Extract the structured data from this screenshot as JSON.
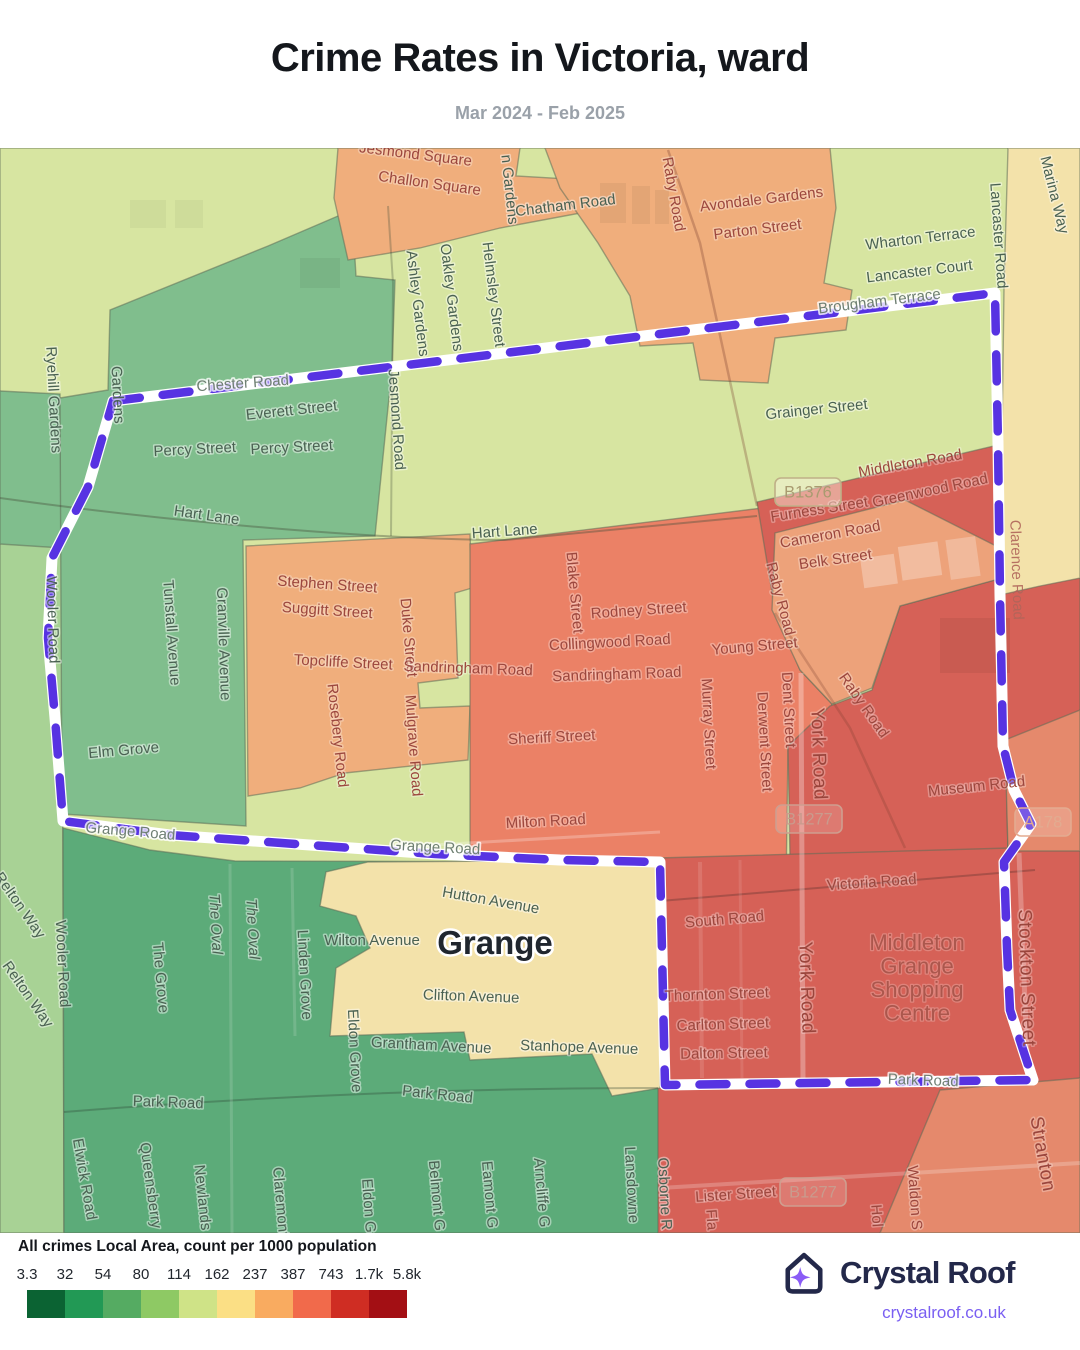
{
  "header": {
    "title": "Crime Rates in Victoria, ward",
    "subtitle": "Mar 2024 - Feb 2025"
  },
  "legend": {
    "title": "All crimes Local Area, count per 1000 population",
    "ticks": [
      "3.3",
      "32",
      "54",
      "80",
      "114",
      "162",
      "237",
      "387",
      "743",
      "1.7k",
      "5.8k"
    ],
    "colors": [
      "#0b6333",
      "#229955",
      "#55ab62",
      "#8ec964",
      "#cfe387",
      "#fbdf85",
      "#f9ab60",
      "#f16a4b",
      "#cf2d23",
      "#a30f14"
    ]
  },
  "footer": {
    "brand": "Crystal Roof",
    "url": "crystalroof.co.uk",
    "brand_color": "#23284a",
    "accent_color": "#8a5cf6",
    "link_color": "#7a5ff2"
  },
  "map": {
    "boundary_color": "#5733e2",
    "colors": {
      "pale_green": "#d7e5a1",
      "green": "#80be8d",
      "dark_green": "#5cab79",
      "light_green": "#a8d295",
      "orange": "#f0ae7c",
      "light_orange": "#eda27a",
      "salmon": "#eb8166",
      "red": "#d66157",
      "red_light": "#e5896c",
      "pale_yellow": "#f3e2aa"
    },
    "place": {
      "t": "Grange",
      "x": 495,
      "y": 806
    },
    "shopping_centre": {
      "lines": [
        "Middleton",
        "Grange",
        "Shopping",
        "Centre"
      ],
      "x": 917,
      "y": 802,
      "lh": 23.5
    },
    "badges": [
      {
        "t": "B1376",
        "x": 808,
        "y": 344,
        "theme": "tan"
      },
      {
        "t": "B1277",
        "x": 809,
        "y": 671,
        "theme": "red"
      },
      {
        "t": "B1277",
        "x": 813,
        "y": 1044,
        "theme": "red"
      },
      {
        "t": "A178",
        "x": 1043,
        "y": 674,
        "theme": "lightred"
      }
    ],
    "labels": [
      {
        "t": "Jesmond Square",
        "x": 415,
        "y": 11,
        "r": 7,
        "c": "rd"
      },
      {
        "t": "Challon Square",
        "x": 429,
        "y": 40,
        "r": 8,
        "c": "rd"
      },
      {
        "t": "n Gardens",
        "x": 505,
        "y": 42,
        "r": 84,
        "c": "g"
      },
      {
        "t": "Chatham Road",
        "x": 566,
        "y": 62,
        "r": -7,
        "c": "g"
      },
      {
        "t": "Raby Road",
        "x": 669,
        "y": 47,
        "r": 80,
        "c": "rd"
      },
      {
        "t": "Avondale Gardens",
        "x": 762,
        "y": 56,
        "r": -7,
        "c": "rd"
      },
      {
        "t": "Parton Street",
        "x": 758,
        "y": 86,
        "r": -7,
        "c": "rd"
      },
      {
        "t": "Wharton Terrace",
        "x": 921,
        "y": 95,
        "r": -7,
        "c": "g"
      },
      {
        "t": "Lancaster Court",
        "x": 920,
        "y": 128,
        "r": -7,
        "c": "g"
      },
      {
        "t": "Lancaster Road",
        "x": 994,
        "y": 88,
        "r": 86,
        "c": "g"
      },
      {
        "t": "Marina Way",
        "x": 1050,
        "y": 48,
        "r": 76,
        "c": "g"
      },
      {
        "t": "Ashley Gardens",
        "x": 413,
        "y": 156,
        "r": 83,
        "c": "g"
      },
      {
        "t": "Oakley Gardens",
        "x": 447,
        "y": 150,
        "r": 83,
        "c": "g"
      },
      {
        "t": "Helmsley Street",
        "x": 489,
        "y": 147,
        "r": 83,
        "c": "g"
      },
      {
        "t": "Ryehill Gardens",
        "x": 49,
        "y": 252,
        "r": 87,
        "c": "g"
      },
      {
        "t": "Gardens",
        "x": 113,
        "y": 247,
        "r": 87,
        "c": "g"
      },
      {
        "t": "Chester Road",
        "x": 243,
        "y": 240,
        "r": -4,
        "c": "ft"
      },
      {
        "t": "Everett Street",
        "x": 292,
        "y": 267,
        "r": -6,
        "c": "g"
      },
      {
        "t": "Percy Street",
        "x": 195,
        "y": 306,
        "r": -3,
        "c": "g"
      },
      {
        "t": "Percy Street",
        "x": 292,
        "y": 304,
        "r": -3,
        "c": "g"
      },
      {
        "t": "Jesmond Road",
        "x": 392,
        "y": 272,
        "r": 86,
        "c": "g"
      },
      {
        "t": "Brougham Terrace",
        "x": 880,
        "y": 158,
        "r": -7,
        "c": "ft"
      },
      {
        "t": "Grainger Street",
        "x": 817,
        "y": 266,
        "r": -6,
        "c": "g"
      },
      {
        "t": "Middleton Road",
        "x": 911,
        "y": 320,
        "r": -10,
        "c": "rd"
      },
      {
        "t": "Furness Street",
        "x": 820,
        "y": 366,
        "r": -9,
        "c": "rd"
      },
      {
        "t": "Greenwood Road",
        "x": 931,
        "y": 347,
        "r": -12,
        "c": "rd"
      },
      {
        "t": "Cameron Road",
        "x": 831,
        "y": 391,
        "r": -10,
        "c": "rd"
      },
      {
        "t": "Belk Street",
        "x": 836,
        "y": 416,
        "r": -8,
        "c": "rd"
      },
      {
        "t": "Hart Lane",
        "x": 206,
        "y": 372,
        "r": 8,
        "c": "g"
      },
      {
        "t": "Hart Lane",
        "x": 505,
        "y": 388,
        "r": -4,
        "c": "g"
      },
      {
        "t": "Raby Road",
        "x": 776,
        "y": 452,
        "r": 75,
        "c": "rd"
      },
      {
        "t": "Stephen Street",
        "x": 327,
        "y": 441,
        "r": 4,
        "c": "rd"
      },
      {
        "t": "Suggitt Street",
        "x": 327,
        "y": 467,
        "r": 4,
        "c": "rd"
      },
      {
        "t": "Topcliffe Street",
        "x": 343,
        "y": 519,
        "r": 3,
        "c": "rd"
      },
      {
        "t": "Duke Street",
        "x": 404,
        "y": 490,
        "r": 85,
        "c": "rd"
      },
      {
        "t": "Sandringham Road",
        "x": 468,
        "y": 525,
        "r": 2,
        "c": "rd"
      },
      {
        "t": "Blake Street",
        "x": 570,
        "y": 445,
        "r": 85,
        "c": "rd"
      },
      {
        "t": "Rodney Street",
        "x": 639,
        "y": 467,
        "r": -4,
        "c": "rd"
      },
      {
        "t": "Collingwood Road",
        "x": 610,
        "y": 499,
        "r": -3,
        "c": "rd"
      },
      {
        "t": "Sandringham Road",
        "x": 617,
        "y": 531,
        "r": -2,
        "c": "rd"
      },
      {
        "t": "Young Street",
        "x": 755,
        "y": 503,
        "r": -5,
        "c": "rd"
      },
      {
        "t": "Rosebery Road",
        "x": 333,
        "y": 588,
        "r": 84,
        "c": "rd"
      },
      {
        "t": "Mulgrave Road",
        "x": 409,
        "y": 598,
        "r": 86,
        "c": "rd"
      },
      {
        "t": "Sheriff Street",
        "x": 552,
        "y": 594,
        "r": -3,
        "c": "rd"
      },
      {
        "t": "Murray Street",
        "x": 704,
        "y": 576,
        "r": 87,
        "c": "rd"
      },
      {
        "t": "Derwent Street",
        "x": 760,
        "y": 594,
        "r": 87,
        "c": "rd"
      },
      {
        "t": "Dent Street",
        "x": 784,
        "y": 562,
        "r": 87,
        "c": "rd"
      },
      {
        "t": "York Road",
        "x": 813,
        "y": 606,
        "r": 88,
        "c": "rb"
      },
      {
        "t": "Raby Road",
        "x": 860,
        "y": 560,
        "r": 55,
        "c": "rd"
      },
      {
        "t": "Museum Road",
        "x": 977,
        "y": 643,
        "r": -6,
        "c": "rd"
      },
      {
        "t": "Clarence Road",
        "x": 1012,
        "y": 422,
        "r": 88,
        "c": "rf"
      },
      {
        "t": "Elm Grove",
        "x": 124,
        "y": 607,
        "r": -5,
        "c": "g"
      },
      {
        "t": "Tunstall Avenue",
        "x": 167,
        "y": 485,
        "r": 86,
        "c": "g"
      },
      {
        "t": "Granville Avenue",
        "x": 219,
        "y": 496,
        "r": 88,
        "c": "g"
      },
      {
        "t": "Wooler Road",
        "x": 48,
        "y": 472,
        "r": 88,
        "c": "g"
      },
      {
        "t": "Grange Road",
        "x": 130,
        "y": 688,
        "r": 5,
        "c": "ft"
      },
      {
        "t": "Grange Road",
        "x": 435,
        "y": 704,
        "r": 3,
        "c": "ft"
      },
      {
        "t": "Milton Road",
        "x": 546,
        "y": 678,
        "r": -3,
        "c": "rd"
      },
      {
        "t": "Victoria Road",
        "x": 872,
        "y": 739,
        "r": -4,
        "c": "rd"
      },
      {
        "t": "South Road",
        "x": 725,
        "y": 776,
        "r": -5,
        "c": "rd"
      },
      {
        "t": "Relton Way",
        "x": 16,
        "y": 760,
        "r": 55,
        "c": "g"
      },
      {
        "t": "Relton Way",
        "x": 24,
        "y": 849,
        "r": 55,
        "c": "g"
      },
      {
        "t": "Wooler Road",
        "x": 58,
        "y": 816,
        "r": 87,
        "c": "g"
      },
      {
        "t": "The Grove",
        "x": 156,
        "y": 830,
        "r": 85,
        "c": "g"
      },
      {
        "t": "The Oval",
        "x": 211,
        "y": 776,
        "r": 87,
        "c": "gi"
      },
      {
        "t": "The Oval",
        "x": 248,
        "y": 781,
        "r": 87,
        "c": "gi"
      },
      {
        "t": "Linden Grove",
        "x": 300,
        "y": 827,
        "r": 87,
        "c": "g"
      },
      {
        "t": "Wilton Avenue",
        "x": 372,
        "y": 797,
        "r": 0,
        "c": "g"
      },
      {
        "t": "Hutton Avenue",
        "x": 490,
        "y": 757,
        "r": 10,
        "c": "g"
      },
      {
        "t": "Clifton Avenue",
        "x": 471,
        "y": 853,
        "r": 2,
        "c": "g"
      },
      {
        "t": "Grantham Avenue",
        "x": 431,
        "y": 902,
        "r": 3,
        "c": "g"
      },
      {
        "t": "Stanhope Avenue",
        "x": 579,
        "y": 904,
        "r": 2,
        "c": "g"
      },
      {
        "t": "Eldon Grove",
        "x": 350,
        "y": 903,
        "r": 87,
        "c": "g"
      },
      {
        "t": "Thornton Street",
        "x": 717,
        "y": 851,
        "r": -2,
        "c": "rd"
      },
      {
        "t": "Carlton Street",
        "x": 723,
        "y": 881,
        "r": -2,
        "c": "rd"
      },
      {
        "t": "Dalton Street",
        "x": 724,
        "y": 910,
        "r": -1,
        "c": "rd"
      },
      {
        "t": "York Road",
        "x": 801,
        "y": 840,
        "r": 88,
        "c": "rb"
      },
      {
        "t": "Stockton Street",
        "x": 1021,
        "y": 830,
        "r": 88,
        "c": "rb"
      },
      {
        "t": "Park Road",
        "x": 168,
        "y": 959,
        "r": 2,
        "c": "g"
      },
      {
        "t": "Park Road",
        "x": 437,
        "y": 951,
        "r": 6,
        "c": "g"
      },
      {
        "t": "Park Road",
        "x": 923,
        "y": 937,
        "r": 2,
        "c": "ft"
      },
      {
        "t": "Lister Street",
        "x": 736,
        "y": 1051,
        "r": -4,
        "c": "rd"
      },
      {
        "t": "Stranton",
        "x": 1037,
        "y": 1007,
        "r": 80,
        "c": "rb"
      },
      {
        "t": "Waldon S",
        "x": 910,
        "y": 1050,
        "r": 86,
        "c": "rd"
      },
      {
        "t": "Hol",
        "x": 872,
        "y": 1068,
        "r": 86,
        "c": "rd"
      },
      {
        "t": "Fla",
        "x": 707,
        "y": 1072,
        "r": 86,
        "c": "rd"
      },
      {
        "t": "Elwick Road",
        "x": 80,
        "y": 1032,
        "r": 80,
        "c": "g"
      },
      {
        "t": "Queensberry",
        "x": 146,
        "y": 1038,
        "r": 82,
        "c": "g"
      },
      {
        "t": "Newlands",
        "x": 198,
        "y": 1050,
        "r": 84,
        "c": "g"
      },
      {
        "t": "Claremont",
        "x": 276,
        "y": 1054,
        "r": 85,
        "c": "g"
      },
      {
        "t": "Eldon G",
        "x": 364,
        "y": 1058,
        "r": 86,
        "c": "g"
      },
      {
        "t": "Belmont G",
        "x": 432,
        "y": 1048,
        "r": 85,
        "c": "g"
      },
      {
        "t": "Eamont G",
        "x": 485,
        "y": 1047,
        "r": 85,
        "c": "g"
      },
      {
        "t": "Arncliffe G",
        "x": 537,
        "y": 1045,
        "r": 85,
        "c": "g"
      },
      {
        "t": "Lansdowne",
        "x": 627,
        "y": 1037,
        "r": 87,
        "c": "g"
      },
      {
        "t": "Osborne R",
        "x": 660,
        "y": 1046,
        "r": 87,
        "c": "g"
      }
    ]
  }
}
